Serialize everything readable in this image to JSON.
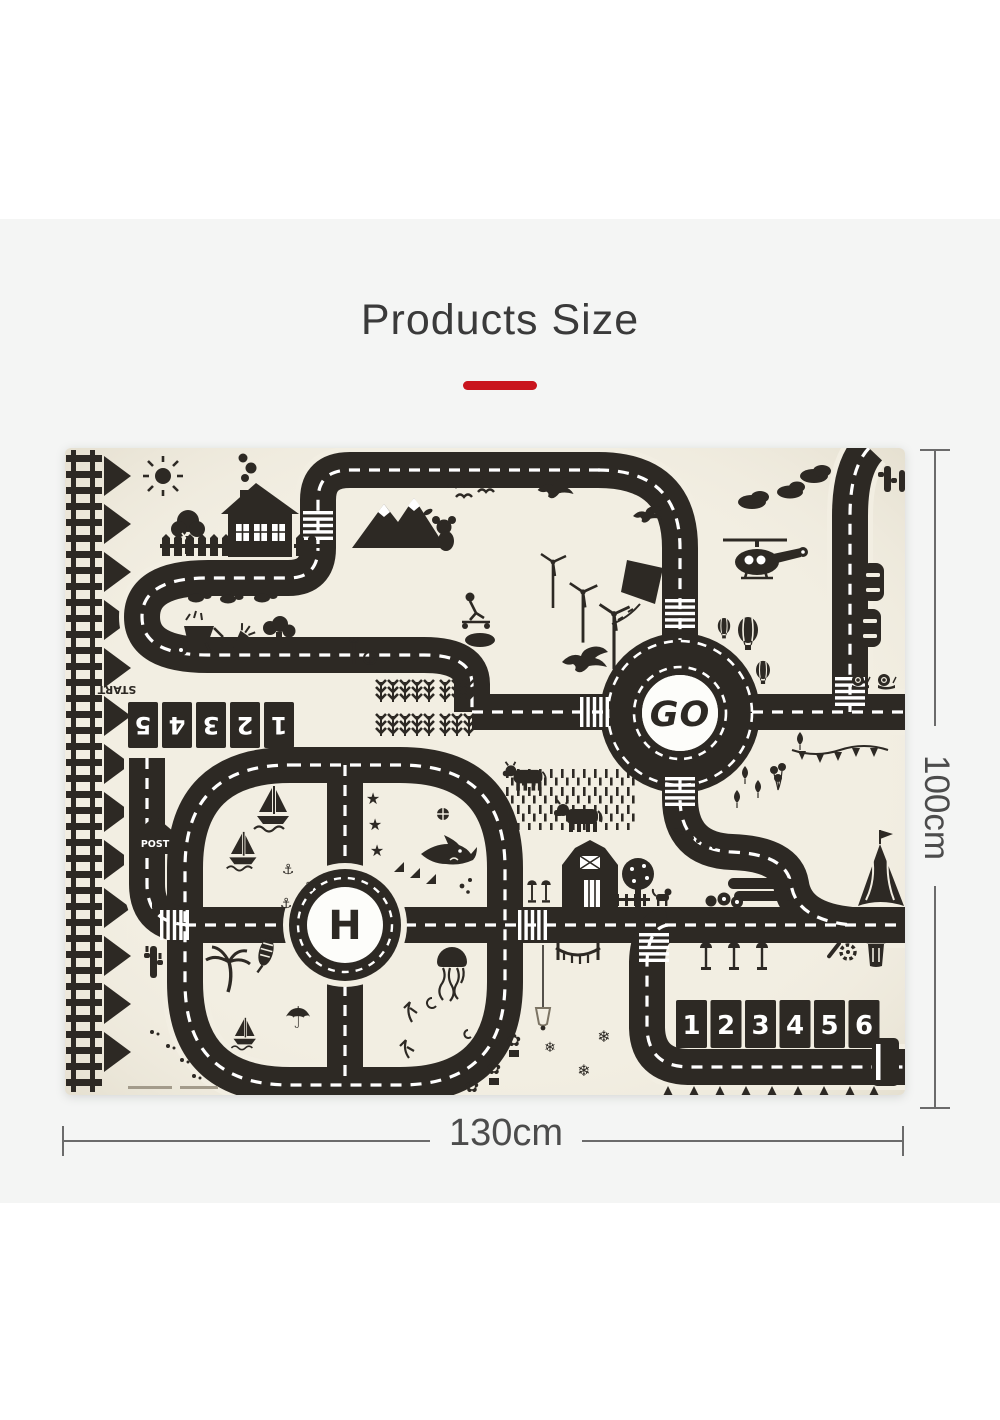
{
  "page": {
    "title": "Products Size"
  },
  "dimensions": {
    "width": "130cm",
    "height": "100cm"
  },
  "mat": {
    "roundabout_label": "GO",
    "helipad_label": "H",
    "post_label": "POST",
    "start_label": "START",
    "parking_numbers": [
      "1",
      "2",
      "3",
      "4",
      "5",
      "6"
    ],
    "start_lane_numbers": [
      "5",
      "4",
      "3",
      "2",
      "1"
    ],
    "icons": {
      "star": "★",
      "snowflake": "❄",
      "flower": "✿",
      "anchor": "⚓",
      "umbrella": "☂"
    },
    "colors": {
      "accent_red": "#c9151e",
      "road_ink": "#2d2924",
      "mat_background": "#f2eee2"
    }
  }
}
